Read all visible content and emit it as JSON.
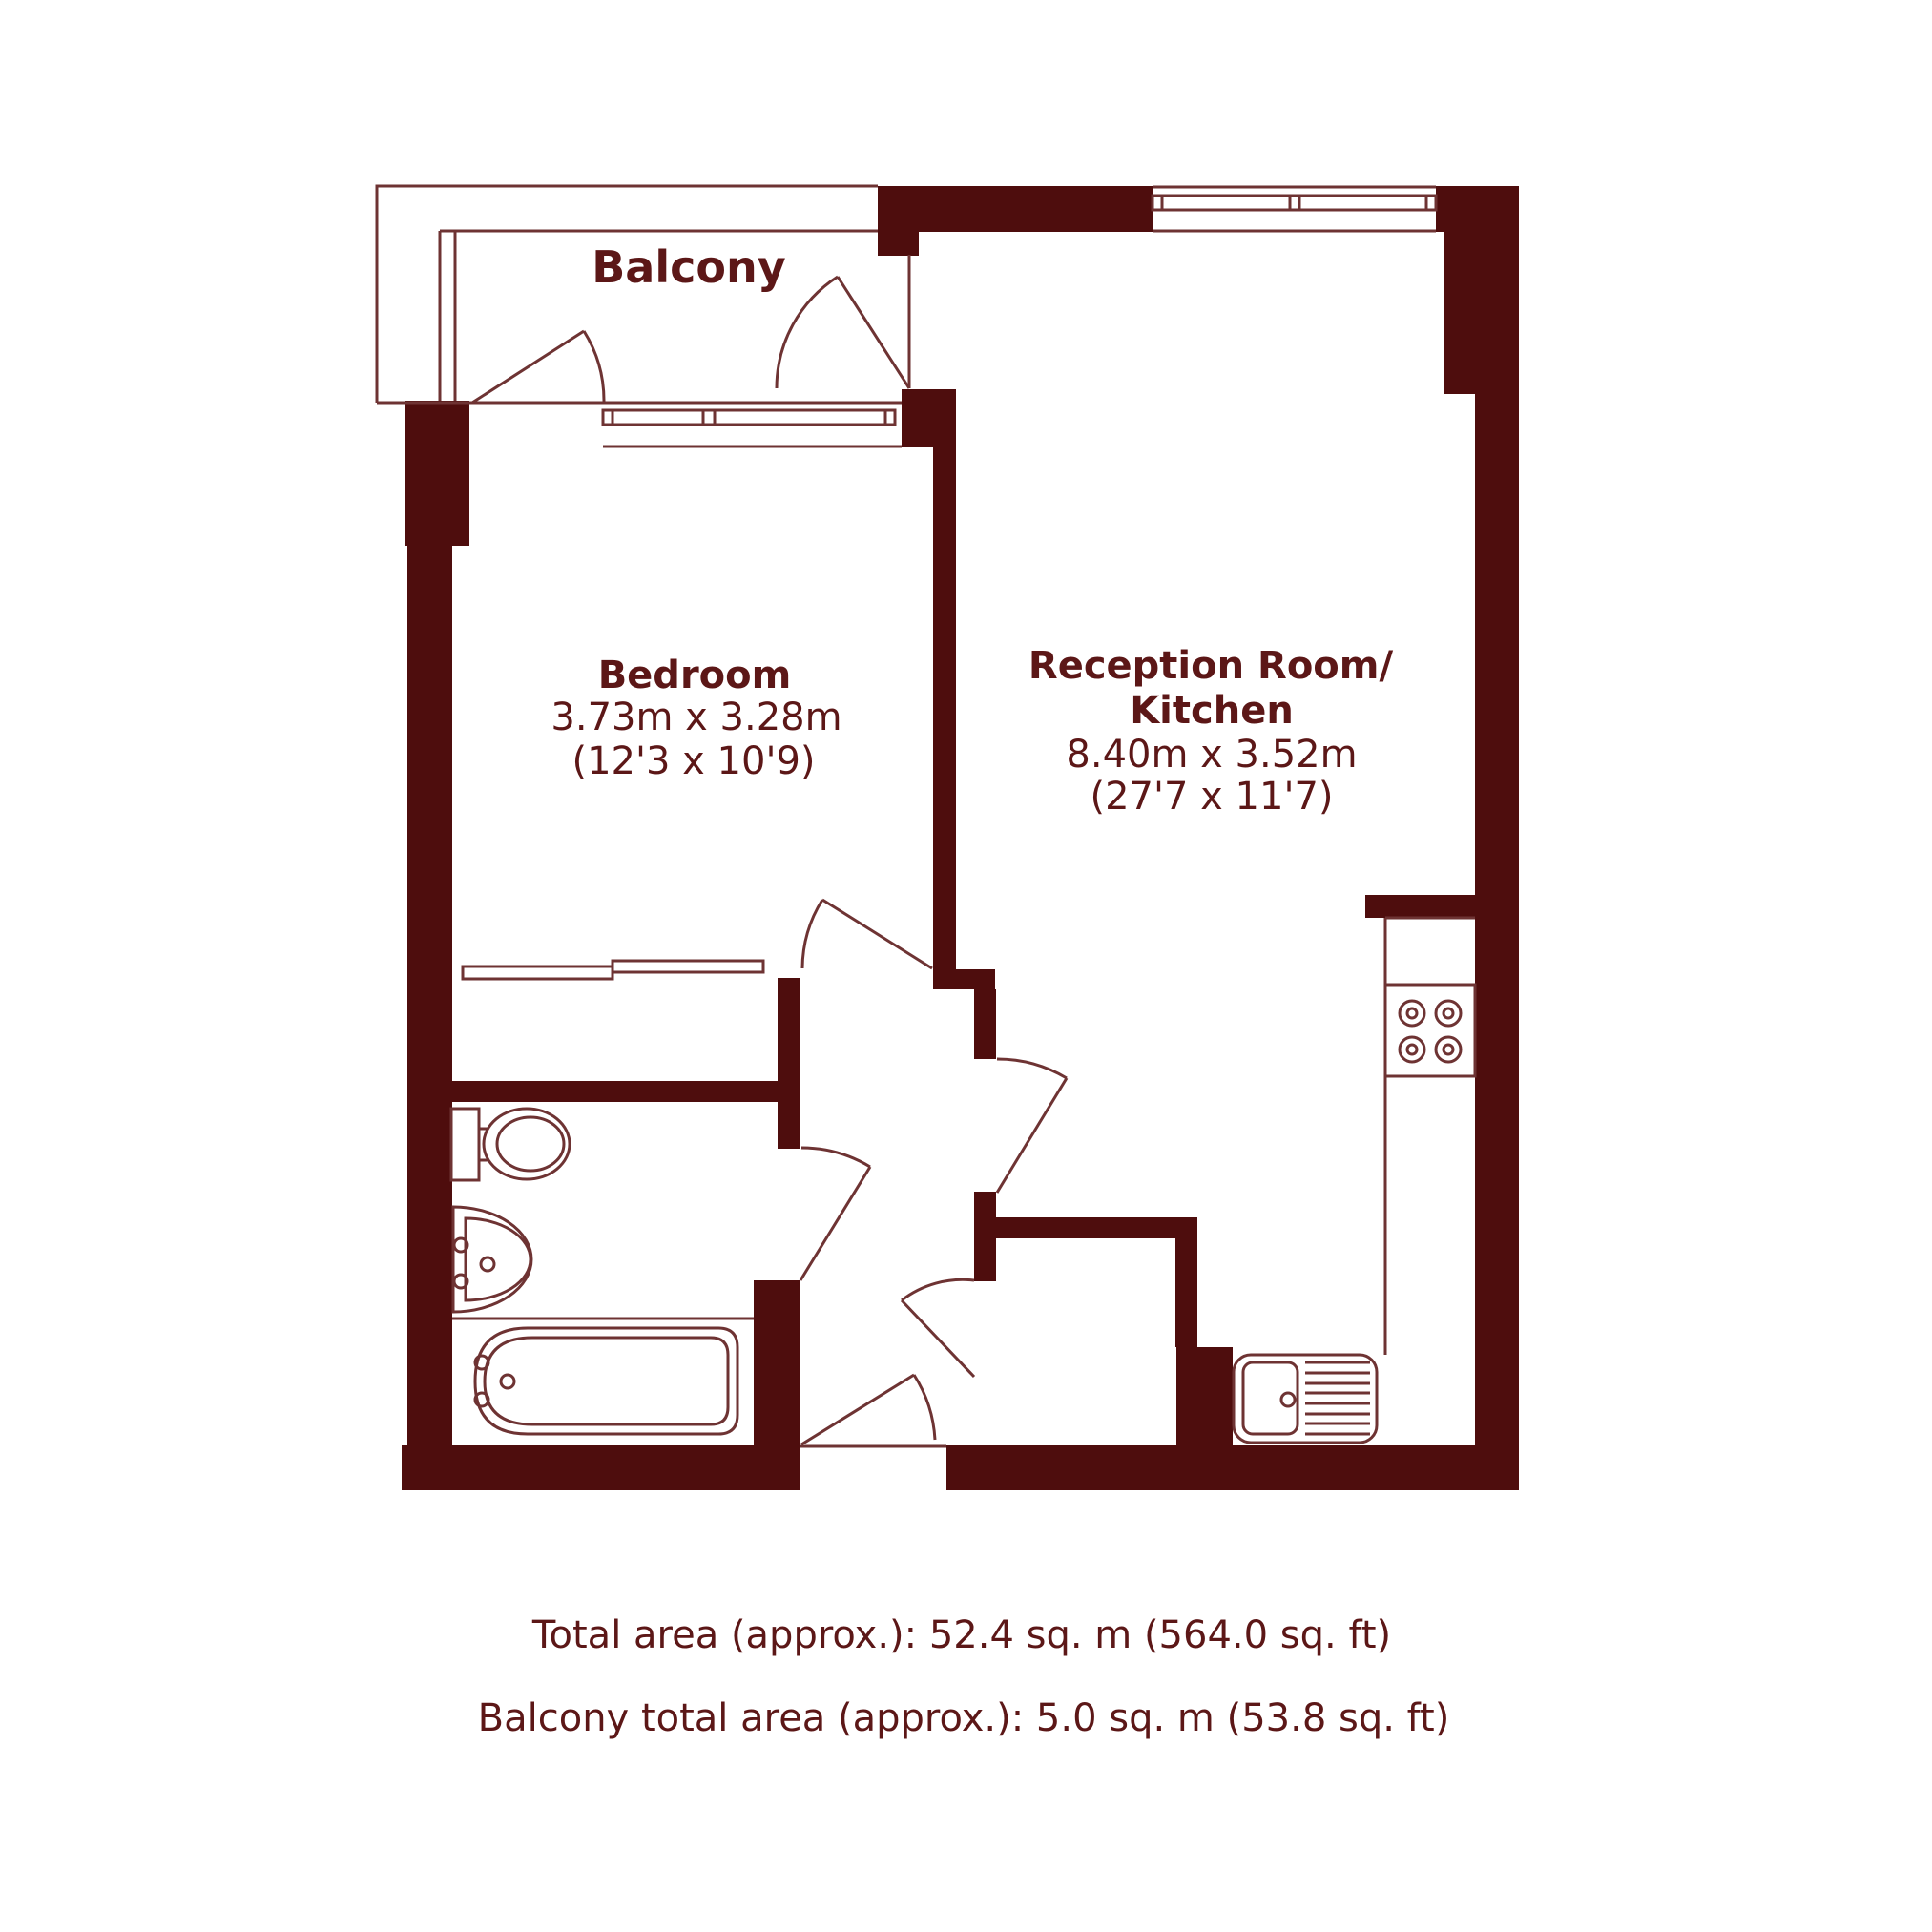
{
  "title": "Floor plan",
  "rooms": {
    "balcony": {
      "label": "Balcony"
    },
    "bedroom": {
      "label": "Bedroom",
      "dimensions_metric": "3.73m x 3.28m",
      "dimensions_imperial": "(12'3 x 10'9)"
    },
    "reception": {
      "label_line1": "Reception Room/",
      "label_line2": "Kitchen",
      "dimensions_metric": "8.40m x 3.52m",
      "dimensions_imperial": "(27'7 x 11'7)"
    }
  },
  "footer": {
    "total_area": "Total area (approx.): 52.4 sq. m (564.0 sq. ft)",
    "balcony_area": "Balcony total area (approx.): 5.0 sq. m (53.8 sq. ft)"
  },
  "fixtures": [
    "toilet",
    "bathroom-sink",
    "bathtub",
    "hob",
    "kitchen-sink",
    "wardrobe"
  ],
  "windows": [
    "bedroom-balcony-window",
    "reception-window"
  ],
  "doors": [
    "balcony-door-left",
    "balcony-door-right",
    "bedroom-door",
    "reception-door",
    "bathroom-door",
    "entry-door",
    "hall-cupboard-door"
  ],
  "colors": {
    "wall": "#4e0d0d",
    "line": "#6e3333",
    "text": "#5c1717",
    "background": "#ffffff"
  }
}
